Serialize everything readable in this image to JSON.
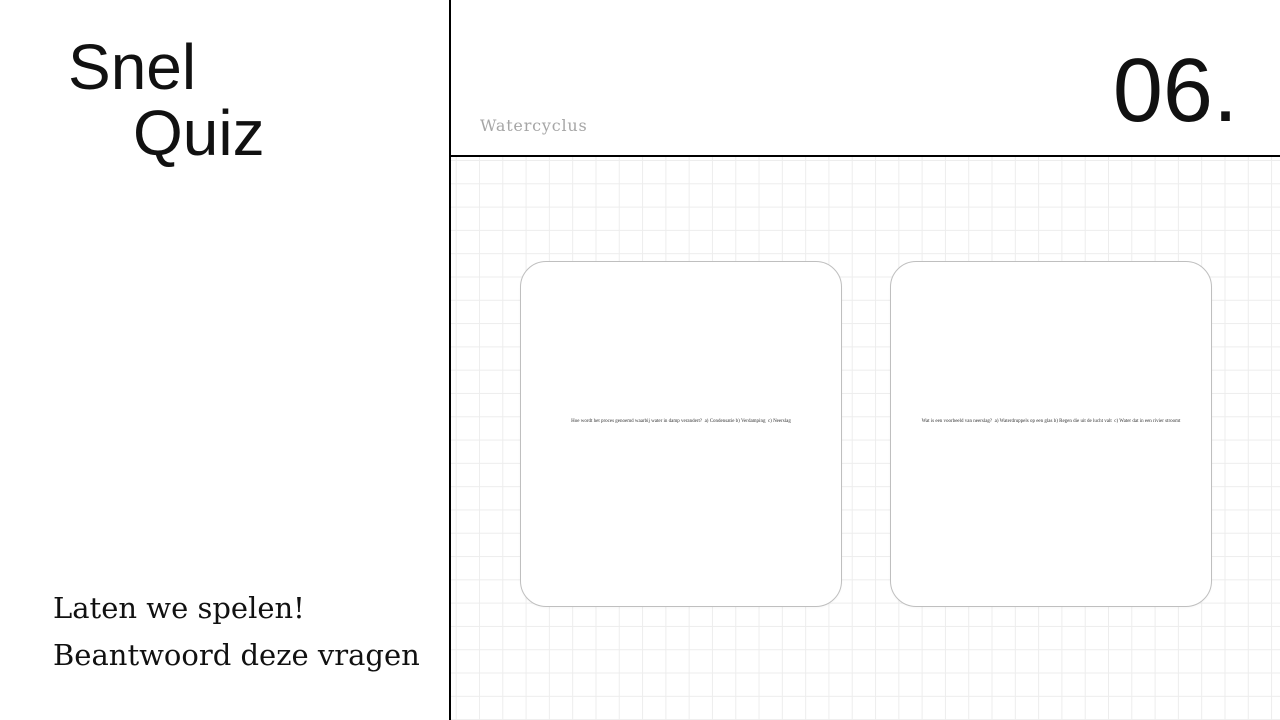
{
  "slide": {
    "title_line1": "Snel",
    "title_line2": "Quiz",
    "cta_line1": "Laten we spelen!",
    "cta_line2": "Beantwoord deze vragen",
    "topic_label": "Watercyclus",
    "slide_number": "06."
  },
  "cards": [
    {
      "question": "Hoe wordt het proces genoemd waarbij water in damp verandert?  a) Condensatie b) Verdamping  c) Neerslag"
    },
    {
      "question": "Wat is een voorbeeld van neerslag?  a) Waterdruppels op een glas b) Regen die uit de lucht valt  c) Water dat in een rivier stroomt"
    }
  ],
  "colors": {
    "background": "#ffffff",
    "text_primary": "#111111",
    "topic_label": "#a6a6a6",
    "divider": "#000000",
    "grid_line": "#ededed",
    "card_border": "#bfbfbf"
  }
}
